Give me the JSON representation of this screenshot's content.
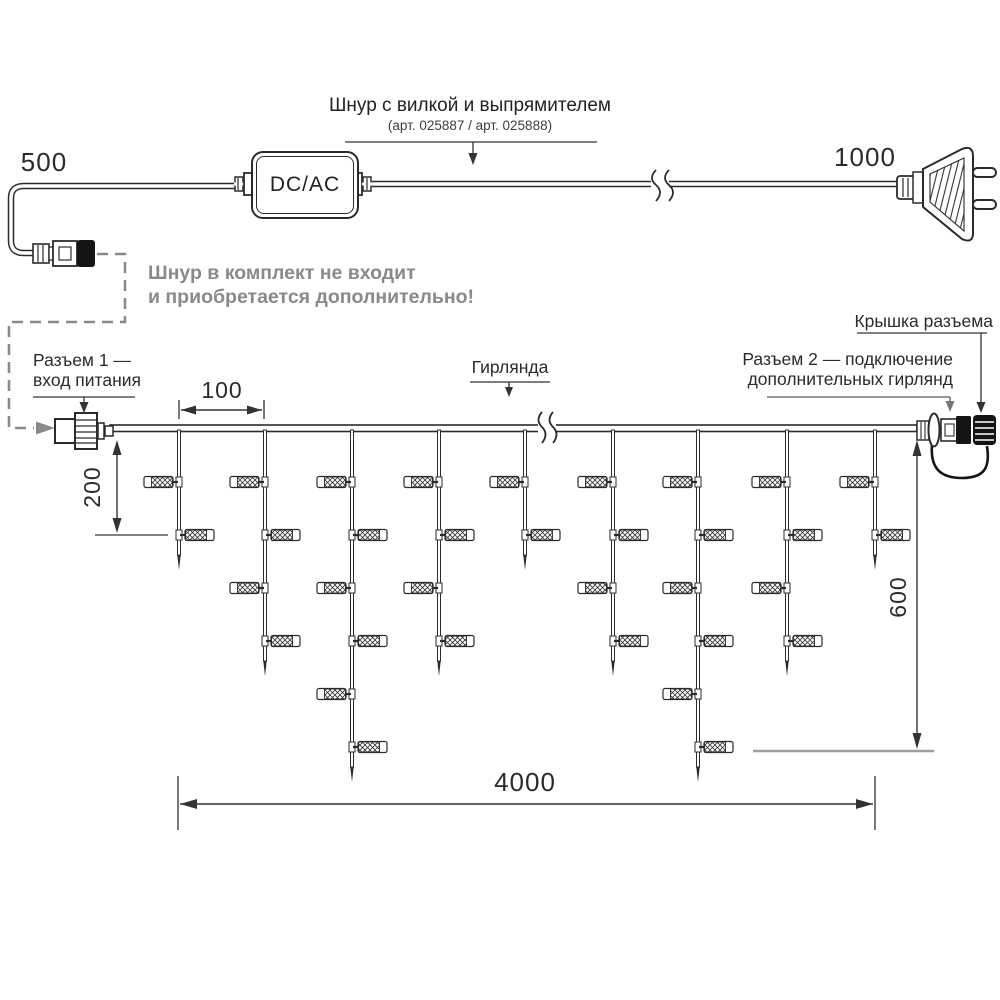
{
  "diagram": {
    "title": {
      "line1": "Шнур с вилкой и выпрямителем",
      "line2": "(арт. 025887 / арт. 025888)"
    },
    "note": {
      "line1": "Шнур в комплект не входит",
      "line2": "и приобретается дополнительно!"
    },
    "labels": {
      "converter": "DC/AC",
      "connector1_line1": "Разъем 1 —",
      "connector1_line2": "вход питания",
      "garland": "Гирлянда",
      "cap": "Крышка разъема",
      "connector2_line1": "Разъем 2 — подключение",
      "connector2_line2": "дополнительных гирлянд"
    },
    "dimensions": {
      "cord_left": "500",
      "cord_right": "1000",
      "drop_spacing": "100",
      "drop_short": "200",
      "drop_long": "600",
      "garland_length": "4000"
    },
    "colors": {
      "line": "#2b2b2b",
      "hatch": "#333333",
      "muted": "#8a8a8a",
      "tick": "#9e9e9e",
      "black_part": "#141414"
    },
    "garland": {
      "wire_y": 425,
      "wire_x1": 110,
      "wire_x2": 917,
      "lamp_first_y": 482,
      "lamp_step_y": 53,
      "drops": [
        {
          "x": 179,
          "lamps": 2
        },
        {
          "x": 265,
          "lamps": 4
        },
        {
          "x": 352,
          "lamps": 6
        },
        {
          "x": 439,
          "lamps": 4
        },
        {
          "x": 525,
          "lamps": 2
        },
        {
          "x": 613,
          "lamps": 4
        },
        {
          "x": 698,
          "lamps": 6
        },
        {
          "x": 787,
          "lamps": 4
        },
        {
          "x": 875,
          "lamps": 2
        }
      ]
    }
  }
}
